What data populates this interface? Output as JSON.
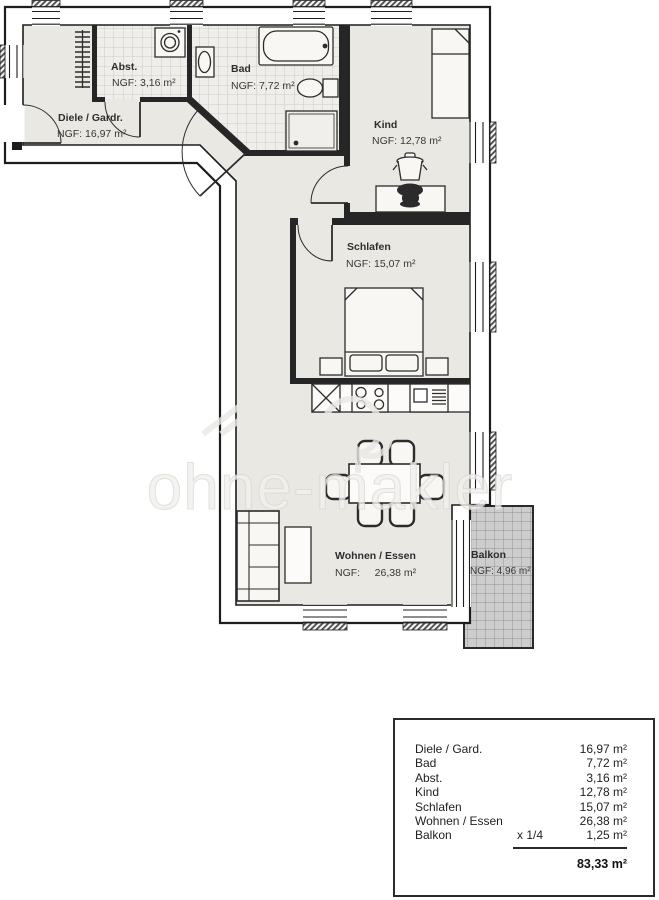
{
  "watermark": {
    "brand": "ohne-makler"
  },
  "rooms": {
    "diele": {
      "name": "Diele / Gardr.",
      "ngf": "NGF: 16,97 m²"
    },
    "abst": {
      "name": "Abst.",
      "ngf": "NGF: 3,16 m²"
    },
    "bad": {
      "name": "Bad",
      "ngf": "NGF: 7,72 m²"
    },
    "kind": {
      "name": "Kind",
      "ngf": "NGF: 12,78 m²"
    },
    "schlafen": {
      "name": "Schlafen",
      "ngf": "NGF: 15,07 m²"
    },
    "wohnen": {
      "name": "Wohnen / Essen",
      "ngf": "NGF:     26,38 m²"
    },
    "balkon": {
      "name": "Balkon",
      "ngf": "NGF: 4,96 m²"
    }
  },
  "legend": {
    "rows": [
      {
        "label": "Diele / Gard.",
        "factor": "",
        "value": "16,97 m²"
      },
      {
        "label": "Bad",
        "factor": "",
        "value": "7,72 m²"
      },
      {
        "label": "Abst.",
        "factor": "",
        "value": "3,16 m²"
      },
      {
        "label": "Kind",
        "factor": "",
        "value": "12,78 m²"
      },
      {
        "label": "Schlafen",
        "factor": "",
        "value": "15,07 m²"
      },
      {
        "label": "Wohnen / Essen",
        "factor": "",
        "value": "26,38 m²"
      },
      {
        "label": "Balkon",
        "factor": "x 1/4",
        "value": "1,25 m²"
      }
    ],
    "total": "83,33 m²"
  },
  "colors": {
    "floor": "#eae8e3",
    "tile_floor": "#f0eeea",
    "wall": "#1d1d1d",
    "balcony_fill": "#cdcdcd",
    "balcony_grid": "#8f8f8f",
    "watermark": "#f2f1ee"
  }
}
